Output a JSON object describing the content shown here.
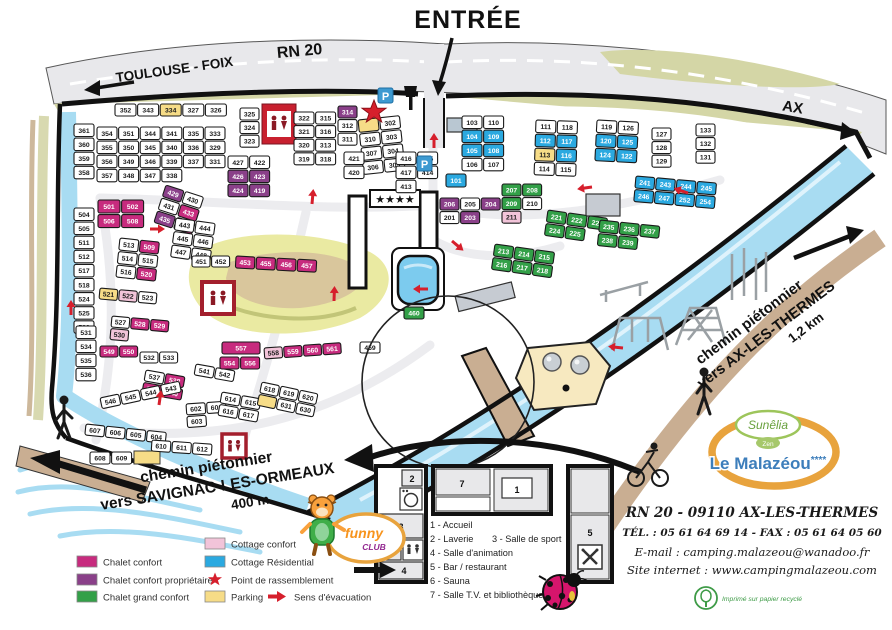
{
  "title": "Plan du camping Le Malazéou",
  "colors": {
    "road": "#E8E8EB",
    "olive": "#D4D6A6",
    "river": "#A8DCF2",
    "river_hi": "#DFF3FC",
    "path_tan": "#C9AE92",
    "sand": "#F7E9C0",
    "hill": "#EAEAA2",
    "hill_path": "#D9C69C",
    "red": "#D61F2C",
    "magenta": "#C72B7E",
    "purple": "#8A4089",
    "green": "#33A048",
    "pink": "#F2C4D9",
    "cyan": "#2BA9E0",
    "yellow": "#F6DC87",
    "white_plot": "#FFFFFF",
    "parking_blue": "#3D9AD1",
    "logo_orange": "#E8A33D",
    "logo_blue": "#3D7EBB",
    "logo_green": "#69A13E",
    "funny_orange": "#F7941D",
    "funny_purple": "#92278F",
    "eco_green": "#3E9B47"
  },
  "top": {
    "entree": "ENTRÉE",
    "road_left": "TOULOUSE - FOIX",
    "road_name": "RN 20",
    "road_right": "AX"
  },
  "paths": {
    "right_line1": "chemin piétonnier",
    "right_line2": "vers AX-LES-THERMES",
    "right_line3": "1,2 km",
    "left_line1": "chemin piétonnier",
    "left_line2": "vers SAVIGNAC-LES-ORMEAUX",
    "left_line3": "400 m"
  },
  "facilities": {
    "stars_sign": "★★★★",
    "parking_sign": "P"
  },
  "legend": {
    "items": [
      {
        "label": "Chalet confort",
        "type": "swatch",
        "color_key": "magenta"
      },
      {
        "label": "Chalet confort propriétaire",
        "type": "swatch",
        "color_key": "purple"
      },
      {
        "label": "Chalet grand confort",
        "type": "swatch",
        "color_key": "green"
      },
      {
        "label": "Cottage confort",
        "type": "swatch",
        "color_key": "pink"
      },
      {
        "label": "Cottage Résidential",
        "type": "swatch",
        "color_key": "cyan"
      },
      {
        "label": "Point de rassemblement",
        "type": "star",
        "color_key": "red"
      },
      {
        "label": "Parking",
        "type": "swatch",
        "color_key": "yellow"
      },
      {
        "label": "Sens d'évacuation",
        "type": "arrow",
        "color_key": "red"
      }
    ]
  },
  "inset": {
    "rooms": {
      "r1": "1",
      "r2": "2",
      "r3": "3",
      "r4": "4",
      "r5": "5",
      "r6": "6",
      "r7": "7"
    },
    "legend_lines": [
      "1 - Accueil",
      "2 - Laverie",
      "3 - Salle de sport",
      "4 - Salle d'animation",
      "5 - Bar / restaurant",
      "6 - Sauna",
      "7 - Salle T.V. et bibliothèque"
    ]
  },
  "contact": {
    "sunelia": "Sunêlia",
    "zen": "Zen",
    "brand": "Le Malazéou",
    "brand_stars": "****",
    "address": "RN 20 - 09110 AX-LES-THERMES",
    "tel_fax": "TÉL. : 05 61 64 69 14 - FAX : 05 61 64 05 60",
    "email": "E-mail : camping.malazeou@wanadoo.fr",
    "site": "Site internet : www.campingmalazeou.com",
    "eco": "Imprimé sur papier recyclé"
  },
  "funny_club": {
    "line1": "funny",
    "line2": "CLUB"
  },
  "map": {
    "clusters": [
      {
        "x": 115,
        "y": 104,
        "cols": 6,
        "w": 21,
        "h": 12,
        "plots": [
          "352",
          "343",
          "334:y",
          "327",
          "326"
        ]
      },
      {
        "x": 74,
        "y": 124,
        "cols": 1,
        "w": 20,
        "h": 12.5,
        "plots": [
          "361",
          "360",
          "359",
          "358"
        ]
      },
      {
        "x": 97,
        "y": 127,
        "cols": 6,
        "w": 20,
        "h": 12.5,
        "plots": [
          "354",
          "351",
          "344",
          "341",
          "335",
          "333",
          "355",
          "350",
          "345",
          "340",
          "336",
          "329",
          "356",
          "349",
          "346",
          "339",
          "337",
          "331",
          "357",
          "348",
          "347",
          "338"
        ]
      },
      {
        "x": 240,
        "y": 108,
        "cols": 1,
        "w": 19,
        "h": 12,
        "plots": [
          "325",
          "324",
          "323"
        ]
      },
      {
        "x": 294,
        "y": 112,
        "cols": 2,
        "w": 20,
        "h": 12,
        "plots": [
          "322",
          "315",
          "321",
          "316",
          "320",
          "313",
          "319",
          "318"
        ]
      },
      {
        "x": 338,
        "y": 106,
        "cols": 1,
        "w": 19,
        "h": 12,
        "plots": [
          "314:p",
          "312",
          "311"
        ]
      },
      {
        "x": 358,
        "y": 120,
        "cols": 2,
        "w": 20,
        "h": 12.5,
        "r": -6,
        "plots": [
          ":y",
          "302",
          "310",
          "303",
          "307",
          "304",
          "306",
          "305"
        ]
      },
      {
        "x": 446,
        "y": 174,
        "cols": 1,
        "w": 20,
        "h": 13,
        "plots": [
          "101:c"
        ]
      },
      {
        "x": 462,
        "y": 116,
        "cols": 2,
        "w": 20,
        "h": 12.5,
        "plots": [
          "103",
          "110",
          "104:c",
          "109:c",
          "105:c",
          "108:c",
          "106",
          "107"
        ]
      },
      {
        "x": 536,
        "y": 120,
        "cols": 2,
        "w": 20,
        "h": 12.5,
        "r": 2,
        "plots": [
          "111",
          "118",
          "112:c",
          "117:c",
          "113:y",
          "116:c",
          "114",
          "115"
        ]
      },
      {
        "x": 597,
        "y": 120,
        "cols": 2,
        "w": 20,
        "h": 12.5,
        "r": 3,
        "plots": [
          "119",
          "126",
          "120:c",
          "125:c",
          "124:c",
          "122:c"
        ]
      },
      {
        "x": 652,
        "y": 128,
        "cols": 1,
        "w": 19,
        "h": 12,
        "plots": [
          "127",
          "128",
          "129"
        ]
      },
      {
        "x": 696,
        "y": 124,
        "cols": 1,
        "w": 19,
        "h": 12,
        "plots": [
          "133",
          "132",
          "131"
        ]
      },
      {
        "x": 440,
        "y": 198,
        "cols": 3,
        "w": 19,
        "h": 12,
        "plots": [
          "206:p",
          "205",
          "204:p",
          "201",
          "203:p"
        ]
      },
      {
        "x": 502,
        "y": 184,
        "cols": 2,
        "w": 19,
        "h": 12,
        "plots": [
          "207:g",
          "208:g",
          "209:g",
          "210",
          "211:pk"
        ]
      },
      {
        "x": 495,
        "y": 244,
        "cols": 3,
        "w": 19,
        "h": 12,
        "r": 8,
        "plots": [
          "213:g",
          "214:g",
          "215:g",
          "216:g",
          "217:g",
          "218:g"
        ]
      },
      {
        "x": 548,
        "y": 210,
        "cols": 3,
        "w": 19,
        "h": 12,
        "r": 8,
        "plots": [
          "221:g",
          "222:g",
          "223:g",
          "224:g",
          "225:g"
        ]
      },
      {
        "x": 600,
        "y": 220,
        "cols": 3,
        "w": 19,
        "h": 12,
        "r": 6,
        "plots": [
          "235:g",
          "236:g",
          "237:g",
          "238:g",
          "239:g"
        ]
      },
      {
        "x": 636,
        "y": 176,
        "cols": 4,
        "w": 19,
        "h": 12,
        "r": 5,
        "plots": [
          "241:c",
          "243:c",
          "244:c",
          "245:c",
          "246:c",
          "247:c",
          "252:c",
          "254:c"
        ]
      },
      {
        "x": 396,
        "y": 152,
        "cols": 2,
        "w": 20,
        "h": 12.5,
        "plots": [
          "416",
          "415",
          "417",
          "414",
          "413"
        ]
      },
      {
        "x": 344,
        "y": 152,
        "cols": 1,
        "w": 20,
        "h": 12.5,
        "plots": [
          "421",
          "420"
        ]
      },
      {
        "x": 228,
        "y": 156,
        "cols": 2,
        "w": 20,
        "h": 12.5,
        "plots": [
          "427",
          "422",
          "426:p",
          "423:p",
          "424:p",
          "419:p"
        ]
      },
      {
        "x": 166,
        "y": 185,
        "cols": 2,
        "w": 19,
        "h": 12,
        "r": 18,
        "plots": [
          "429:p",
          "430",
          "431",
          "433:m",
          "435:p",
          "436:m"
        ]
      },
      {
        "x": 176,
        "y": 218,
        "cols": 2,
        "w": 19,
        "h": 12,
        "r": 8,
        "plots": [
          "443",
          "444",
          "445",
          "446",
          "447",
          "448"
        ]
      },
      {
        "x": 192,
        "y": 256,
        "cols": 2,
        "w": 18,
        "h": 11,
        "plots": [
          "451",
          "452"
        ]
      },
      {
        "x": 236,
        "y": 256,
        "cols": 4,
        "w": 19,
        "h": 12,
        "r": 3,
        "plots": [
          "453:m",
          "455:m",
          "456:m",
          "457:m"
        ]
      },
      {
        "x": 98,
        "y": 200,
        "cols": 2,
        "w": 22,
        "h": 13,
        "plots": [
          "501:m",
          "502:m",
          "506:m",
          "508:m"
        ]
      },
      {
        "x": 74,
        "y": 208,
        "cols": 1,
        "w": 20,
        "h": 12.5,
        "plots": [
          "504",
          "505",
          "511",
          "512",
          "517",
          "518",
          "524",
          "525",
          "526"
        ]
      },
      {
        "x": 76,
        "y": 326,
        "cols": 1,
        "w": 20,
        "h": 12.5,
        "plots": [
          "531",
          "534",
          "535",
          "536"
        ]
      },
      {
        "x": 120,
        "y": 238,
        "cols": 2,
        "w": 19,
        "h": 12,
        "r": 6,
        "plots": [
          "513",
          "509:m",
          "514",
          "515",
          "516",
          "520:m"
        ]
      },
      {
        "x": 100,
        "y": 288,
        "cols": 3,
        "w": 18,
        "h": 11,
        "r": 5,
        "plots": [
          "521:y",
          "522:pk",
          "523"
        ]
      },
      {
        "x": 112,
        "y": 316,
        "cols": 3,
        "w": 18,
        "h": 11,
        "r": 5,
        "plots": [
          "527",
          "528:m",
          "529:m",
          "530:pk"
        ]
      },
      {
        "x": 100,
        "y": 346,
        "cols": 2,
        "w": 18,
        "h": 11,
        "plots": [
          "549:m",
          "550:m"
        ]
      },
      {
        "x": 140,
        "y": 352,
        "cols": 2,
        "w": 18,
        "h": 11,
        "plots": [
          "532",
          "533"
        ]
      },
      {
        "x": 146,
        "y": 370,
        "cols": 2,
        "w": 19,
        "h": 11,
        "r": 10,
        "plots": [
          "537",
          "538:m",
          "539:m",
          "540:m"
        ]
      },
      {
        "x": 196,
        "y": 364,
        "cols": 2,
        "w": 19,
        "h": 11,
        "r": 10,
        "plots": [
          "541",
          "542"
        ]
      },
      {
        "x": 100,
        "y": 398,
        "cols": 4,
        "w": 19,
        "h": 11,
        "r": -12,
        "plots": [
          "546",
          "545",
          "544",
          "543"
        ]
      },
      {
        "x": 222,
        "y": 342,
        "cols": 1,
        "w": 38,
        "h": 12,
        "plots": [
          "557:m"
        ]
      },
      {
        "x": 220,
        "y": 357,
        "cols": 2,
        "w": 19,
        "h": 12,
        "plots": [
          "554:m",
          "556:m"
        ]
      },
      {
        "x": 264,
        "y": 348,
        "cols": 4,
        "w": 18,
        "h": 11,
        "r": -4,
        "plots": [
          "558:pk",
          "559:m",
          "560:m",
          "561:m"
        ]
      },
      {
        "x": 186,
        "y": 404,
        "cols": 2,
        "w": 19,
        "h": 11,
        "r": -4,
        "plots": [
          "602",
          "601",
          "603"
        ]
      },
      {
        "x": 86,
        "y": 424,
        "cols": 4,
        "w": 19,
        "h": 11,
        "r": 6,
        "plots": [
          "607",
          "606",
          "605",
          "604"
        ]
      },
      {
        "x": 90,
        "y": 452,
        "cols": 2,
        "w": 20,
        "h": 12,
        "plots": [
          "608",
          "609"
        ]
      },
      {
        "x": 152,
        "y": 440,
        "cols": 3,
        "w": 19,
        "h": 11,
        "r": 4,
        "plots": [
          "610",
          "611",
          "612"
        ]
      },
      {
        "x": 222,
        "y": 392,
        "cols": 2,
        "w": 19,
        "h": 11,
        "r": 10,
        "plots": [
          "614",
          "615",
          "616",
          "617"
        ]
      },
      {
        "x": 262,
        "y": 382,
        "cols": 3,
        "w": 18,
        "h": 11,
        "r": 12,
        "plots": [
          "618",
          "619",
          "620",
          ":y",
          "631",
          "630"
        ]
      },
      {
        "x": 360,
        "y": 342,
        "cols": 1,
        "w": 20,
        "h": 11,
        "plots": [
          "459"
        ]
      },
      {
        "x": 404,
        "y": 307,
        "cols": 1,
        "w": 20,
        "h": 12,
        "plots": [
          "460:g"
        ]
      }
    ],
    "arrows": [
      [
        150,
        229,
        0
      ],
      [
        312,
        204,
        -85
      ],
      [
        434,
        148,
        -90
      ],
      [
        452,
        241,
        40
      ],
      [
        592,
        187,
        172
      ],
      [
        688,
        193,
        198
      ],
      [
        428,
        289,
        180
      ],
      [
        334,
        301,
        -88
      ],
      [
        71,
        315,
        -90
      ],
      [
        623,
        348,
        186
      ],
      [
        159,
        405,
        -82
      ]
    ]
  }
}
